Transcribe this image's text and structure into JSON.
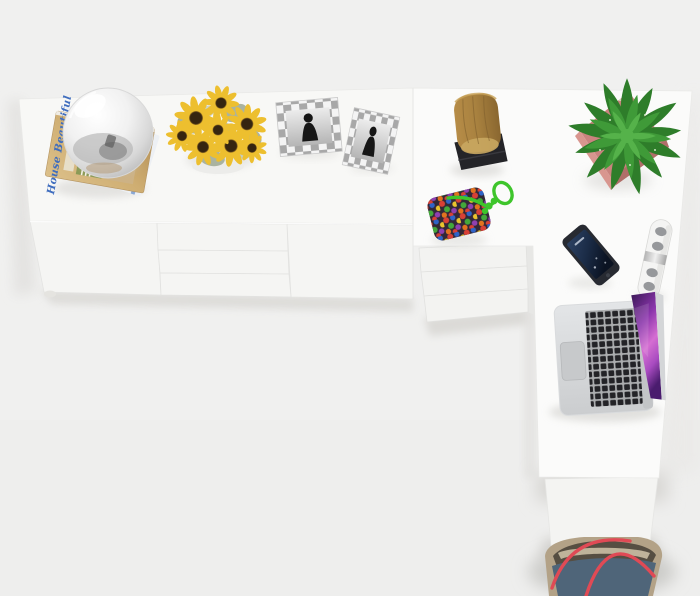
{
  "scene": {
    "name": "Top view of a white L-shaped corner desk with sideboard and decor objects",
    "floor_color": "#f0f0ef"
  },
  "furniture": {
    "sideboard": {
      "label": "white sideboard",
      "top_color": "#f8f8f6",
      "front_color": "#f5f5f3"
    },
    "corner_desk": {
      "label": "white corner desk",
      "top_color": "#fbfbfa",
      "drawer_front_color": "#f3f3f1",
      "panel_color": "#f4f4f2"
    }
  },
  "objects": {
    "magazines": {
      "title": "House Beautiful",
      "title_color": "#3f6dbe",
      "cover_color": "#cfae72",
      "pages_color": "#edf0f4"
    },
    "glass_globe": {
      "glass_color": "#d8d8d8"
    },
    "sunflowers": {
      "petal_color": "#edbf2f",
      "center_color": "#352510",
      "foliage_color": "#aab3a0"
    },
    "photo_frames": {
      "frame_light": "#f4f4f4",
      "frame_dark": "#a8a8a8",
      "photo_color": "#d8d8d8",
      "figure_color": "#161616"
    },
    "wood_stump": {
      "wood_color": "#a8813f",
      "base_color": "#242428"
    },
    "potted_plant": {
      "leaf_outer": "#2e7d2a",
      "leaf_mid": "#3f9a38",
      "leaf_inner": "#55b24a",
      "pot_color": "#c9837e",
      "pot_shade": "#b06e69"
    },
    "beaded_pouch": {
      "cord_color": "#3ec52b",
      "pouch_color": "#332837",
      "bead_colors": [
        "#d84036",
        "#2f63c8",
        "#eac42e",
        "#43a83a",
        "#9040b0",
        "#e2731f"
      ]
    },
    "smartphone": {
      "body_color": "#272a31",
      "screen_color": "#1b2c47"
    },
    "power_strip": {
      "body_color": "#f4f4f3",
      "socket_color": "#96989b"
    },
    "laptop": {
      "body_color": "#d9dbdd",
      "key_color": "#232327",
      "screen_purple": "#b355c6"
    },
    "tote_bag": {
      "body_color": "#4f6579",
      "trim_color": "#b3a287",
      "handle_color": "#e04a55"
    }
  }
}
